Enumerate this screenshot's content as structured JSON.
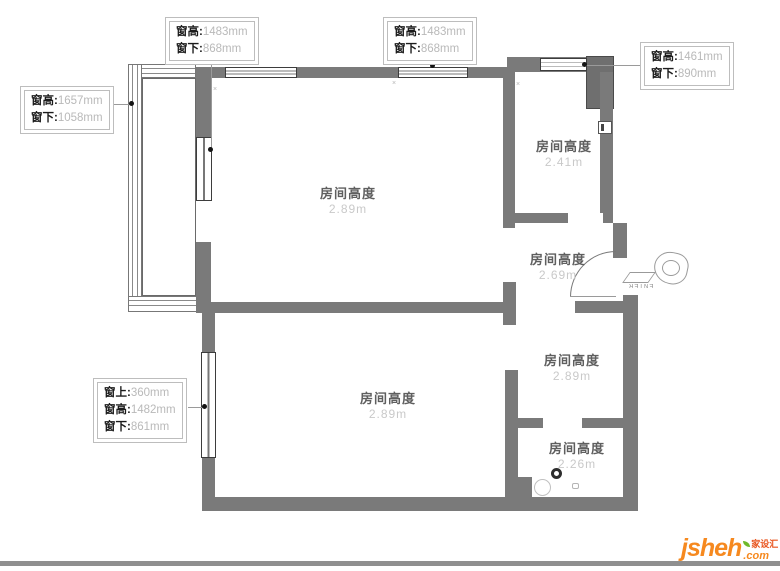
{
  "callouts": {
    "top_left": {
      "rows": [
        {
          "label": "窗高:",
          "value": "1483mm"
        },
        {
          "label": "窗下:",
          "value": "868mm"
        }
      ]
    },
    "top_middle": {
      "rows": [
        {
          "label": "窗高:",
          "value": "1483mm"
        },
        {
          "label": "窗下:",
          "value": "868mm"
        }
      ]
    },
    "top_right": {
      "rows": [
        {
          "label": "窗高:",
          "value": "1461mm"
        },
        {
          "label": "窗下:",
          "value": "890mm"
        }
      ]
    },
    "left": {
      "rows": [
        {
          "label": "窗高:",
          "value": "1657mm"
        },
        {
          "label": "窗下:",
          "value": "1058mm"
        }
      ]
    },
    "bottom_left": {
      "rows": [
        {
          "label": "窗上:",
          "value": "360mm"
        },
        {
          "label": "窗高:",
          "value": "1482mm"
        },
        {
          "label": "窗下:",
          "value": "861mm"
        }
      ]
    }
  },
  "rooms": {
    "living_room": {
      "label": "房间高度",
      "value": "2.89m"
    },
    "kitchen": {
      "label": "房间高度",
      "value": "2.41m"
    },
    "hallway": {
      "label": "房间高度",
      "value": "2.69m"
    },
    "right_room": {
      "label": "房间高度",
      "value": "2.89m"
    },
    "bathroom": {
      "label": "房间高度",
      "value": "2.26m"
    },
    "bedroom": {
      "label": "房间高度",
      "value": "2.89m"
    }
  },
  "entry_marker": {
    "text": "ENTER"
  },
  "decorations": {
    "x_mark": "×"
  },
  "logo": {
    "name": "jsheh",
    "tld": ".com",
    "chinese": "家设汇"
  },
  "colors": {
    "wall": "#7a7a7a",
    "callout_value": "#b9b9b9",
    "room_value": "#c9c9c9",
    "logo_orange": "#f6891f",
    "logo_red": "#e8541d",
    "logo_green": "#6fb92c"
  }
}
